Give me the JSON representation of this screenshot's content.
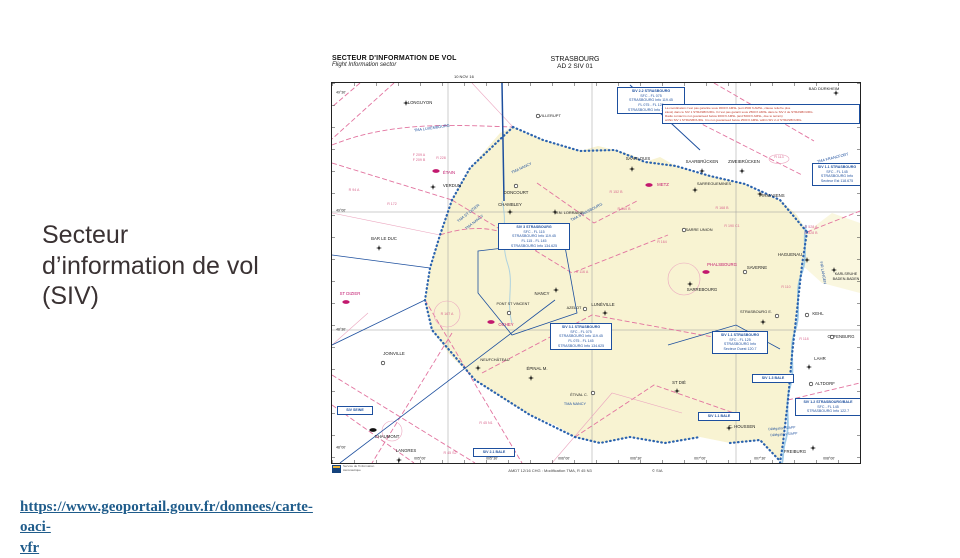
{
  "slide": {
    "title_lines": [
      "Secteur",
      "d’information de vol",
      "(SIV)"
    ],
    "link_line1": "https://www.geoportail.gouv.fr/donnees/carte-oaci-",
    "link_line2": "vfr"
  },
  "chart": {
    "header": {
      "title_fr": "SECTEUR D'INFORMATION DE VOL",
      "title_en": "Flight Information sector",
      "region": "STRASBOURG",
      "code": "AD 2 SIV 01",
      "date": "10 NOV 16"
    },
    "footer": {
      "amendment": "AMDT 12/16 CHG : Modification TMA, R 45 N3",
      "copyright": "© SIA",
      "logo_line1": "Service de l'Information",
      "logo_line2": "Aéronautique"
    },
    "map": {
      "labels": [
        {
          "t": "49°30'",
          "x": 9,
          "y": 10,
          "c": "bk",
          "s": 3.5
        },
        {
          "t": "49°00'",
          "x": 9,
          "y": 128,
          "c": "bk",
          "s": 3.5
        },
        {
          "t": "48°30'",
          "x": 9,
          "y": 247,
          "c": "bk",
          "s": 3.5
        },
        {
          "t": "48°00'",
          "x": 9,
          "y": 365,
          "c": "bk",
          "s": 3.5
        },
        {
          "t": "005°00'",
          "x": 88,
          "y": 376,
          "c": "bk",
          "s": 3.5
        },
        {
          "t": "005°30'",
          "x": 160,
          "y": 376,
          "c": "bk",
          "s": 3.5
        },
        {
          "t": "006°00'",
          "x": 232,
          "y": 376,
          "c": "bk",
          "s": 3.5
        },
        {
          "t": "006°30'",
          "x": 304,
          "y": 376,
          "c": "bk",
          "s": 3.5
        },
        {
          "t": "007°00'",
          "x": 368,
          "y": 376,
          "c": "bk",
          "s": 3.5
        },
        {
          "t": "007°30'",
          "x": 428,
          "y": 376,
          "c": "bk",
          "s": 3.5
        },
        {
          "t": "008°00'",
          "x": 497,
          "y": 376,
          "c": "bk",
          "s": 3.5
        },
        {
          "t": "LONGUYON",
          "x": 88,
          "y": 20,
          "c": "bk"
        },
        {
          "t": "VILLERUPT",
          "x": 218,
          "y": 33,
          "c": "bk",
          "s": 4
        },
        {
          "t": "BAD DÜRKHEIM",
          "x": 492,
          "y": 6,
          "c": "bk",
          "s": 4
        },
        {
          "t": "RAMSTEIN",
          "x": 447,
          "y": 32,
          "c": "mg"
        },
        {
          "t": "SAARLOUIS",
          "x": 306,
          "y": 76,
          "c": "bk"
        },
        {
          "t": "SAARBRÜCKEN",
          "x": 370,
          "y": 79,
          "c": "bk"
        },
        {
          "t": "ZWEIBRÜCKEN",
          "x": 412,
          "y": 79,
          "c": "bk"
        },
        {
          "t": "PIRMASENS",
          "x": 440,
          "y": 113,
          "c": "bk"
        },
        {
          "t": "ÉTAIN",
          "x": 117,
          "y": 90,
          "c": "mg"
        },
        {
          "t": "VERDUN",
          "x": 120,
          "y": 103,
          "c": "bk"
        },
        {
          "t": "DONCOURT",
          "x": 184,
          "y": 110,
          "c": "bk"
        },
        {
          "t": "METZ",
          "x": 331,
          "y": 102,
          "c": "mg"
        },
        {
          "t": "CHAMBLEY",
          "x": 178,
          "y": 122,
          "c": "bk"
        },
        {
          "t": "M.N. LORRAINE",
          "x": 237,
          "y": 130,
          "c": "bk",
          "s": 3.9
        },
        {
          "t": "SARREGUEMINES",
          "x": 382,
          "y": 101,
          "c": "bk",
          "s": 3.9
        },
        {
          "t": "SARRE UNION",
          "x": 367,
          "y": 147,
          "c": "bk",
          "s": 3.9
        },
        {
          "t": "PHALSBOURG",
          "x": 390,
          "y": 182,
          "c": "mg"
        },
        {
          "t": "SARREBOURG",
          "x": 370,
          "y": 207,
          "c": "bk"
        },
        {
          "t": "SAVERNE",
          "x": 425,
          "y": 185,
          "c": "bk"
        },
        {
          "t": "HAGUENAU",
          "x": 458,
          "y": 172,
          "c": "bk"
        },
        {
          "t": "KARLSRUHE",
          "x": 514,
          "y": 192,
          "c": "bk",
          "s": 3.7
        },
        {
          "t": "BADEN-BADEN",
          "x": 514,
          "y": 197,
          "c": "bk",
          "s": 3.7
        },
        {
          "t": "STRASBOURG E.",
          "x": 424,
          "y": 229,
          "c": "bk",
          "s": 3.9
        },
        {
          "t": "KEHL",
          "x": 486,
          "y": 231,
          "c": "bk"
        },
        {
          "t": "OFFENBURG",
          "x": 509,
          "y": 254,
          "c": "bk"
        },
        {
          "t": "LAHR",
          "x": 488,
          "y": 276,
          "c": "bk"
        },
        {
          "t": "ALTDORF",
          "x": 493,
          "y": 301,
          "c": "bk"
        },
        {
          "t": "FREIBURG",
          "x": 463,
          "y": 369,
          "c": "bk"
        },
        {
          "t": "C. HOUSSEN",
          "x": 410,
          "y": 344,
          "c": "bk"
        },
        {
          "t": "ST DIÉ",
          "x": 347,
          "y": 300,
          "c": "bk"
        },
        {
          "t": "ÉTIVAL C.",
          "x": 247,
          "y": 313,
          "c": "bk",
          "s": 3.8
        },
        {
          "t": "ÉPINAL M.",
          "x": 205,
          "y": 286,
          "c": "bk"
        },
        {
          "t": "NEUFCHÂTEAU",
          "x": 163,
          "y": 277,
          "c": "bk",
          "s": 3.9
        },
        {
          "t": "NANCY",
          "x": 210,
          "y": 211,
          "c": "bk"
        },
        {
          "t": "PONT ST VINCENT",
          "x": 181,
          "y": 222,
          "c": "bk",
          "s": 3.7
        },
        {
          "t": "OCHEY",
          "x": 174,
          "y": 242,
          "c": "mg"
        },
        {
          "t": "AZELOT",
          "x": 242,
          "y": 226,
          "c": "bk",
          "s": 3.8
        },
        {
          "t": "LUNÉVILLE",
          "x": 271,
          "y": 222,
          "c": "bk"
        },
        {
          "t": "BAR LE DUC",
          "x": 52,
          "y": 156,
          "c": "bk"
        },
        {
          "t": "ST DIZIER",
          "x": 18,
          "y": 211,
          "c": "mg"
        },
        {
          "t": "JOINVILLE",
          "x": 62,
          "y": 271,
          "c": "bk"
        },
        {
          "t": "CHAUMONT",
          "x": 55,
          "y": 354,
          "c": "bk"
        },
        {
          "t": "LANGRES",
          "x": 74,
          "y": 368,
          "c": "bk"
        },
        {
          "t": "TMA LUXEMBOURG",
          "x": 100,
          "y": 46,
          "c": "bl",
          "s": 3.8,
          "r": -8
        },
        {
          "t": "TMA NANCY",
          "x": 190,
          "y": 86,
          "c": "bl",
          "s": 3.8,
          "r": -25
        },
        {
          "t": "TMA STRASBOURG",
          "x": 255,
          "y": 130,
          "c": "bl",
          "s": 3.8,
          "r": -28
        },
        {
          "t": "TMA ST DIZIER",
          "x": 137,
          "y": 131,
          "c": "bl",
          "s": 3.8,
          "r": -38
        },
        {
          "t": "TMA NANCY",
          "x": 143,
          "y": 140,
          "c": "bl",
          "s": 3.8,
          "r": -38
        },
        {
          "t": "TMA NANCY",
          "x": 243,
          "y": 322,
          "c": "bl",
          "s": 3.8
        },
        {
          "t": "TMA FRANCFORT",
          "x": 501,
          "y": 76,
          "c": "bl",
          "s": 3.8,
          "r": -14
        },
        {
          "t": "FIR LANGEN",
          "x": 490,
          "y": 190,
          "c": "bl",
          "s": 3.8,
          "r": 80
        },
        {
          "t": "Délégation S/APP",
          "x": 450,
          "y": 346,
          "c": "bl",
          "s": 3.4,
          "r": -4
        },
        {
          "t": "Délégation S/APP",
          "x": 452,
          "y": 352,
          "c": "bl",
          "s": 3.4,
          "r": -4
        },
        {
          "t": "F 209 A",
          "x": 87,
          "y": 73,
          "c": "pk",
          "s": 3.6
        },
        {
          "t": "F 209 B",
          "x": 87,
          "y": 78,
          "c": "pk",
          "s": 3.6
        },
        {
          "t": "R 228",
          "x": 109,
          "y": 76,
          "c": "pk",
          "s": 3.6
        },
        {
          "t": "R 94 A",
          "x": 22,
          "y": 108,
          "c": "pk",
          "s": 3.6
        },
        {
          "t": "R 172",
          "x": 60,
          "y": 122,
          "c": "pk",
          "s": 3.6
        },
        {
          "t": "R 152 B",
          "x": 284,
          "y": 110,
          "c": "pk",
          "s": 3.6
        },
        {
          "t": "R 160 B",
          "x": 292,
          "y": 127,
          "c": "pk",
          "s": 3.6
        },
        {
          "t": "R 168 B",
          "x": 390,
          "y": 126,
          "c": "pk",
          "s": 3.6
        },
        {
          "t": "R 190 C1",
          "x": 400,
          "y": 144,
          "c": "pk",
          "s": 3.6
        },
        {
          "t": "R 151",
          "x": 208,
          "y": 153,
          "c": "pk",
          "s": 3.6
        },
        {
          "t": "R 113",
          "x": 447,
          "y": 75,
          "c": "pk",
          "s": 3.6
        },
        {
          "t": "D 528 A",
          "x": 479,
          "y": 145,
          "c": "pk",
          "s": 3.6
        },
        {
          "t": "D 528 B",
          "x": 479,
          "y": 151,
          "c": "pk",
          "s": 3.6
        },
        {
          "t": "R 110",
          "x": 454,
          "y": 205,
          "c": "pk",
          "s": 3.6
        },
        {
          "t": "R 118",
          "x": 472,
          "y": 257,
          "c": "pk",
          "s": 3.6
        },
        {
          "t": "R 116 A",
          "x": 250,
          "y": 190,
          "c": "pk",
          "s": 3.6
        },
        {
          "t": "R 164",
          "x": 330,
          "y": 160,
          "c": "pk",
          "s": 3.6
        },
        {
          "t": "R 167 A",
          "x": 115,
          "y": 232,
          "c": "pk",
          "s": 3.6
        },
        {
          "t": "R 45 N1",
          "x": 154,
          "y": 341,
          "c": "pk",
          "s": 3.6
        },
        {
          "t": "R 45 S2",
          "x": 118,
          "y": 371,
          "c": "pk",
          "s": 3.6
        }
      ],
      "boxes": [
        {
          "x": 285,
          "y": 4,
          "w": 68,
          "lines": [
            "SIV 2.2 STRASBOURG",
            "SFC - FL 075",
            "STRASBOURG Info 119.45",
            "FL 075 - FL 125",
            "STRASBOURG Info 134.875"
          ]
        },
        {
          "x": 330,
          "y": 21,
          "w": 198,
          "red": true,
          "lines": [
            "La coordination n'est pas garantie sous 3000 ft AMSL (soit 4500 ft AMSL, clause relief le plus",
            "élevé) dans le SIV 1 STRASBOURG. Il n'est pas garanti sous 2500 ft AMSL dans le SIV 2 de STRASBOURG.",
            "Radio contact is not guaranteed below 3000 ft AMSL (and 5000 ft AMSL, due to terrain)",
            "within SIV 1 STRASBOURG. It is not guaranteed below 2500 ft AMSL within SIV 2 of STRASBOURG."
          ]
        },
        {
          "x": 480,
          "y": 80,
          "w": 50,
          "lines": [
            "SIV 1.1 STRASBOURG",
            "SFC - FL 145",
            "STRASBOURG Info",
            "Secteur Est 118.675"
          ]
        },
        {
          "x": 166,
          "y": 140,
          "w": 72,
          "lines": [
            "SIV 3 STRASBOURG",
            "SFC - FL 115",
            "STRASBOURG Info 119.45",
            "FL 115 - FL 145",
            "STRASBOURG Info 134.625"
          ]
        },
        {
          "x": 218,
          "y": 240,
          "w": 62,
          "lines": [
            "SIV 3.1 STRASBOURG",
            "SFC - FL 075",
            "STRASBOURG Info 119.45",
            "FL 075 - FL 145",
            "STRASBOURG Info 134.625"
          ]
        },
        {
          "x": 380,
          "y": 248,
          "w": 56,
          "lines": [
            "SIV 1.1 STRASBOURG",
            "SFC - FL 125",
            "STRASBOURG Info",
            "Secteur Ouest 120.7"
          ]
        },
        {
          "x": 420,
          "y": 291,
          "w": 42,
          "lines": [
            "SIV 1.3 BALE"
          ]
        },
        {
          "x": 366,
          "y": 329,
          "w": 42,
          "lines": [
            "SIV 1.1 BALE"
          ]
        },
        {
          "x": 5,
          "y": 323,
          "w": 36,
          "lines": [
            "SIV SEINE"
          ]
        },
        {
          "x": 141,
          "y": 365,
          "w": 42,
          "lines": [
            "SIV 2.1 BALE"
          ]
        },
        {
          "x": 463,
          "y": 315,
          "w": 66,
          "lines": [
            "SIV 1.2 STRASBOURG/BALE",
            "SFC - FL 145",
            "STRASBOURG Info 122.7"
          ]
        }
      ],
      "symbols": [
        {
          "k": "civ",
          "x": 74,
          "y": 20
        },
        {
          "k": "opn",
          "x": 206,
          "y": 33
        },
        {
          "k": "civ",
          "x": 504,
          "y": 10
        },
        {
          "k": "mil",
          "x": 432,
          "y": 32
        },
        {
          "k": "civ",
          "x": 300,
          "y": 86
        },
        {
          "k": "civ",
          "x": 370,
          "y": 88
        },
        {
          "k": "civ",
          "x": 410,
          "y": 88
        },
        {
          "k": "civ",
          "x": 428,
          "y": 111
        },
        {
          "k": "mil",
          "x": 104,
          "y": 88
        },
        {
          "k": "civ",
          "x": 101,
          "y": 104
        },
        {
          "k": "opn",
          "x": 184,
          "y": 103
        },
        {
          "k": "mil",
          "x": 317,
          "y": 102
        },
        {
          "k": "civ",
          "x": 178,
          "y": 129
        },
        {
          "k": "civ",
          "x": 223,
          "y": 129
        },
        {
          "k": "civ",
          "x": 363,
          "y": 107
        },
        {
          "k": "opn",
          "x": 352,
          "y": 147
        },
        {
          "k": "mil",
          "x": 374,
          "y": 189
        },
        {
          "k": "civ",
          "x": 358,
          "y": 201
        },
        {
          "k": "opn",
          "x": 413,
          "y": 189
        },
        {
          "k": "civ",
          "x": 475,
          "y": 177
        },
        {
          "k": "civ",
          "x": 502,
          "y": 187
        },
        {
          "k": "civ",
          "x": 431,
          "y": 239
        },
        {
          "k": "opn",
          "x": 445,
          "y": 233
        },
        {
          "k": "opn",
          "x": 475,
          "y": 232
        },
        {
          "k": "opn",
          "x": 500,
          "y": 254
        },
        {
          "k": "civ",
          "x": 477,
          "y": 284
        },
        {
          "k": "opn",
          "x": 479,
          "y": 301
        },
        {
          "k": "civ",
          "x": 481,
          "y": 365
        },
        {
          "k": "civ",
          "x": 397,
          "y": 345
        },
        {
          "k": "civ",
          "x": 345,
          "y": 308
        },
        {
          "k": "opn",
          "x": 261,
          "y": 310
        },
        {
          "k": "civ",
          "x": 199,
          "y": 295
        },
        {
          "k": "civ",
          "x": 146,
          "y": 285
        },
        {
          "k": "civ",
          "x": 224,
          "y": 207
        },
        {
          "k": "opn",
          "x": 177,
          "y": 230
        },
        {
          "k": "mil",
          "x": 159,
          "y": 239
        },
        {
          "k": "opn",
          "x": 253,
          "y": 226
        },
        {
          "k": "civ",
          "x": 273,
          "y": 230
        },
        {
          "k": "civ",
          "x": 47,
          "y": 165
        },
        {
          "k": "mil",
          "x": 14,
          "y": 219
        },
        {
          "k": "opn",
          "x": 51,
          "y": 280
        },
        {
          "k": "blk",
          "x": 41,
          "y": 347
        },
        {
          "k": "civ",
          "x": 67,
          "y": 377
        }
      ]
    }
  }
}
